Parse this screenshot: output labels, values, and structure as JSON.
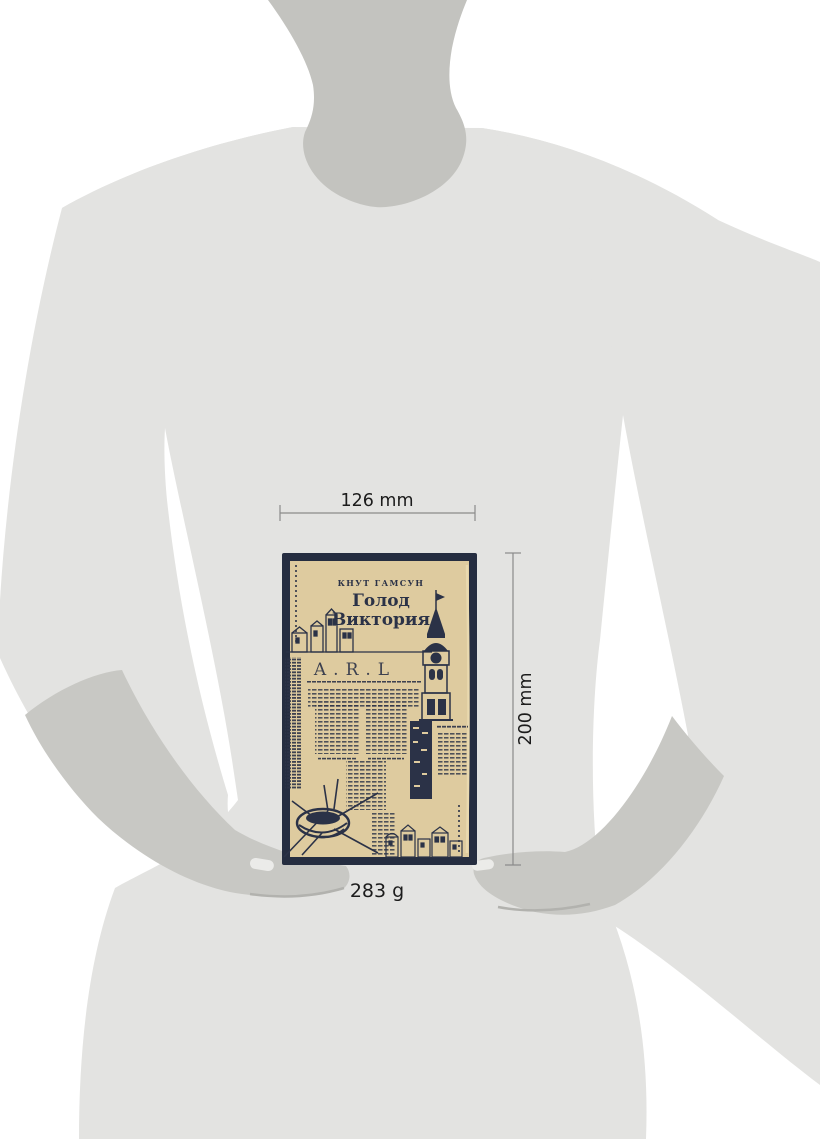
{
  "dimensions": {
    "width": "126 mm",
    "height": "200 mm",
    "weight": "283 g"
  },
  "book": {
    "author": "КНУТ ГАМСУН",
    "title_line1": "Голод",
    "title_line2": "Виктория",
    "cover_monogram": "A.R.L"
  },
  "colors": {
    "background": "#ffffff",
    "body_silhouette": "#e3e3e1",
    "neck_silhouette": "#c3c3bf",
    "forearm_silhouette": "#c8c8c4",
    "nail_highlight": "#ebebe9",
    "book_frame": "#252d40",
    "book_cover": "#decb9f",
    "book_ink": "#2b3247",
    "dimension_line": "#8a8a8a",
    "dimension_text": "#1c1c1c"
  }
}
